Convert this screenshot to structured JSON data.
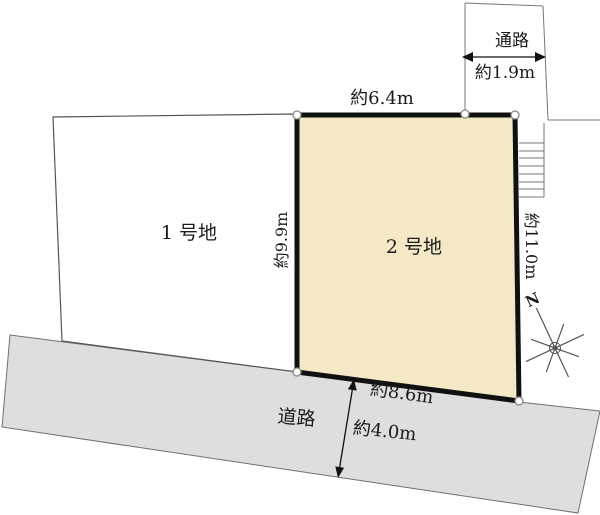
{
  "diagram": {
    "type": "land-lot-plan",
    "lots": [
      {
        "id": "lot-1",
        "label": "1 号地",
        "highlighted": false
      },
      {
        "id": "lot-2",
        "label": "2 号地",
        "highlighted": true
      }
    ],
    "passage": {
      "label": "通路",
      "width": "約1.9m"
    },
    "road": {
      "label": "道路",
      "width": "約4.0m"
    },
    "measurements": {
      "lot2_top": "約6.4m",
      "lot2_left": "約9.9m",
      "lot2_right": "約11.0m",
      "lot2_bottom": "約8.6m"
    },
    "compass": {
      "label": "N"
    },
    "colors": {
      "lot2_fill": "#f5e8c6",
      "road_fill": "#dedede",
      "lot_outline": "#111111",
      "thin_line": "#777777"
    }
  }
}
